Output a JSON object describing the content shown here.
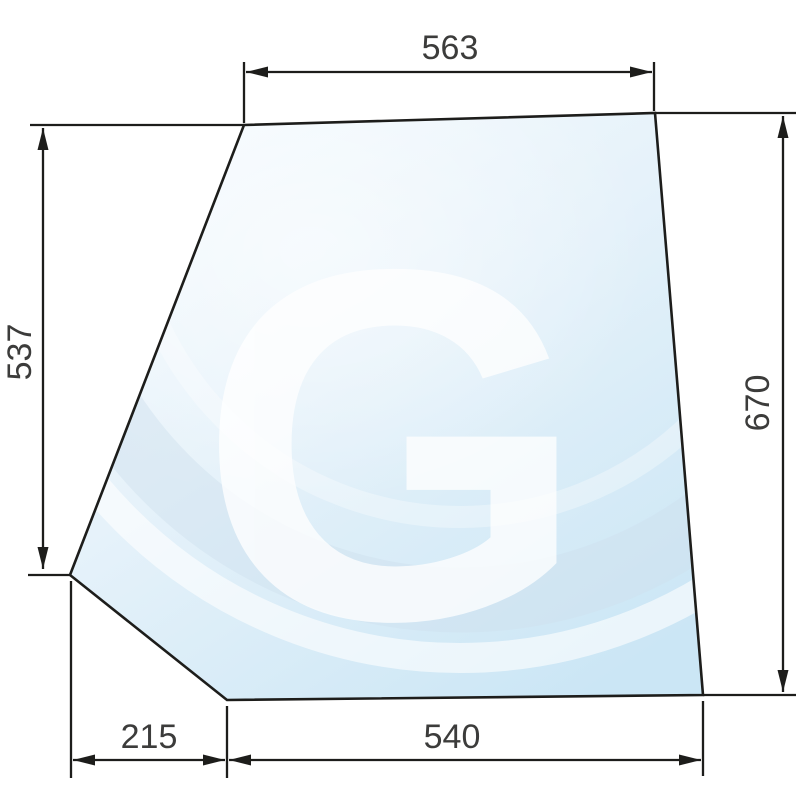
{
  "part": {
    "name": "cab-glass-pane",
    "watermark_letter": "G"
  },
  "dimensions": {
    "top_width": "563",
    "left_height": "537",
    "right_height": "670",
    "bottom_left_width": "215",
    "bottom_width": "540"
  },
  "colors": {
    "line": "#1d1d1b",
    "dimension_text": "#3c3c3b",
    "glass_light": "#f6fbfe",
    "glass_mid": "#e6f2fa",
    "glass_deep": "#cbe6f5",
    "swoosh_light": "#ffffff",
    "swoosh_dark": "#cfdfee",
    "watermark": "#ffffff",
    "background": "#ffffff"
  }
}
